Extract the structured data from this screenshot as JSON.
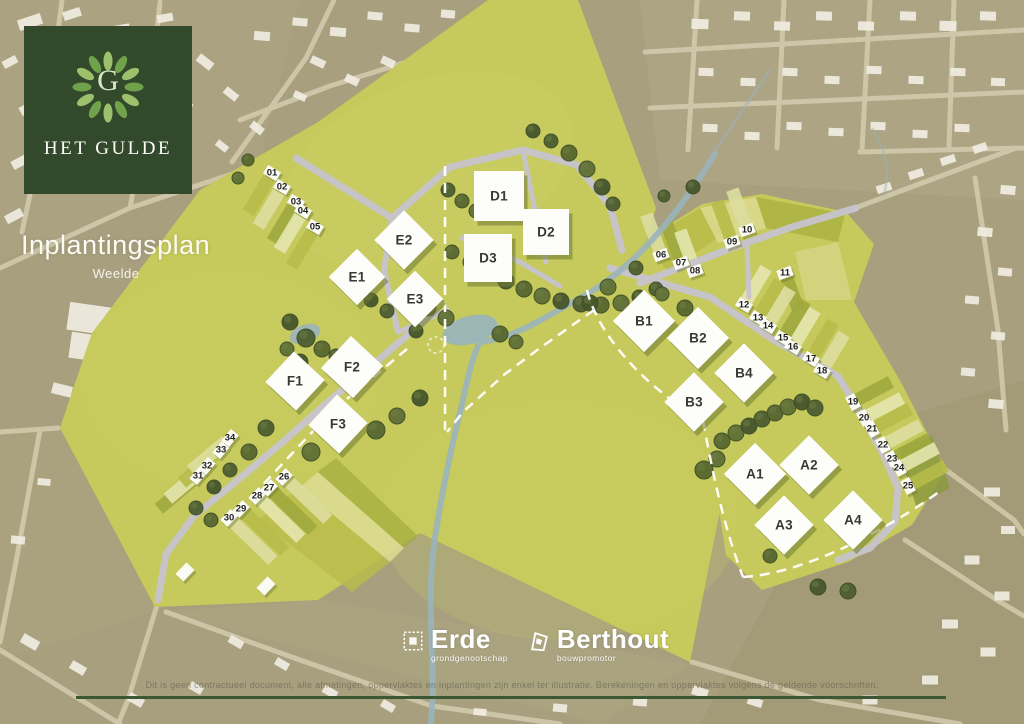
{
  "header": {
    "logo_monogram": "G",
    "brand_name": "HET GULDE",
    "title": "Inplantingsplan",
    "subtitle": "Weelde"
  },
  "partners": {
    "erde": {
      "name": "Erde",
      "tagline": "grondgenootschap"
    },
    "berthout": {
      "name": "Berthout",
      "tagline": "bouwpromotor"
    }
  },
  "footer": {
    "disclaimer": "Dit is geen contractueel document, alle afmetingen, oppervlaktes en inplantingen zijn enkel ter illustratie. Berekeningen en oppervlaktes volgens de geldende voorschriften."
  },
  "colors": {
    "site_green": "#c6c95b",
    "aerial_taupe": "#a79f7e",
    "road_grey": "#c7c4ce",
    "aerial_road": "#d9d2b5",
    "tree_green": "#4d5d31",
    "water_blue": "#9ab4bb",
    "logo_green": "#33492c",
    "footer_line_green": "#3b5733",
    "building_white": "#f0ede2",
    "parcel_palette": [
      "#b7bb49",
      "#dddea0",
      "#9fa93e",
      "#e4e5ae"
    ]
  },
  "map": {
    "groups": [
      {
        "angle": 31,
        "prot": 121,
        "poff": 26,
        "plen": 40
      },
      {
        "angle": -20,
        "prot": -110,
        "poff": 24,
        "plen": 38
      },
      {
        "angle": -20,
        "prot": -110,
        "poff": 24,
        "plen": 38
      },
      {
        "angle": -20,
        "prot": 70,
        "poff": 22,
        "plen": 34
      },
      {
        "angle": 31,
        "prot": -59,
        "poff": 24,
        "plen": 38
      },
      {
        "angle": 62,
        "prot": -28,
        "poff": 24,
        "plen": 38
      },
      {
        "angle": -46,
        "prot": 44,
        "poff": 32,
        "plen": 58
      },
      {
        "angle": -50,
        "prot": 140,
        "poff": 28,
        "plen": 46
      }
    ],
    "lots": [
      {
        "n": "01",
        "x": 272,
        "y": 173,
        "g": 0
      },
      {
        "n": "02",
        "x": 282,
        "y": 187,
        "g": 0
      },
      {
        "n": "03",
        "x": 296,
        "y": 202,
        "g": 0
      },
      {
        "n": "04",
        "x": 303,
        "y": 211,
        "g": 0
      },
      {
        "n": "05",
        "x": 315,
        "y": 227,
        "g": 0
      },
      {
        "n": "06",
        "x": 661,
        "y": 255,
        "g": 1
      },
      {
        "n": "07",
        "x": 681,
        "y": 263,
        "g": 1
      },
      {
        "n": "08",
        "x": 695,
        "y": 271,
        "g": 1
      },
      {
        "n": "09",
        "x": 732,
        "y": 242,
        "g": 2
      },
      {
        "n": "10",
        "x": 747,
        "y": 230,
        "g": 2
      },
      {
        "n": "11",
        "x": 785,
        "y": 273,
        "g": 3
      },
      {
        "n": "12",
        "x": 744,
        "y": 305,
        "g": 4
      },
      {
        "n": "13",
        "x": 758,
        "y": 318,
        "g": 4
      },
      {
        "n": "14",
        "x": 768,
        "y": 326,
        "g": 4
      },
      {
        "n": "15",
        "x": 783,
        "y": 338,
        "g": 4
      },
      {
        "n": "16",
        "x": 793,
        "y": 347,
        "g": 4
      },
      {
        "n": "17",
        "x": 811,
        "y": 359,
        "g": 4
      },
      {
        "n": "18",
        "x": 822,
        "y": 371,
        "g": 4
      },
      {
        "n": "19",
        "x": 853,
        "y": 402,
        "g": 5
      },
      {
        "n": "20",
        "x": 864,
        "y": 418,
        "g": 5
      },
      {
        "n": "21",
        "x": 872,
        "y": 429,
        "g": 5
      },
      {
        "n": "22",
        "x": 883,
        "y": 445,
        "g": 5
      },
      {
        "n": "23",
        "x": 892,
        "y": 459,
        "g": 5
      },
      {
        "n": "24",
        "x": 899,
        "y": 468,
        "g": 5
      },
      {
        "n": "25",
        "x": 908,
        "y": 486,
        "g": 5
      },
      {
        "n": "26",
        "x": 284,
        "y": 477,
        "g": 6
      },
      {
        "n": "27",
        "x": 269,
        "y": 488,
        "g": 6
      },
      {
        "n": "28",
        "x": 257,
        "y": 496,
        "g": 6
      },
      {
        "n": "29",
        "x": 241,
        "y": 509,
        "g": 6
      },
      {
        "n": "30",
        "x": 229,
        "y": 518,
        "g": 6
      },
      {
        "n": "31",
        "x": 198,
        "y": 476,
        "g": 7
      },
      {
        "n": "32",
        "x": 207,
        "y": 466,
        "g": 7
      },
      {
        "n": "33",
        "x": 221,
        "y": 450,
        "g": 7
      },
      {
        "n": "34",
        "x": 230,
        "y": 438,
        "g": 7
      }
    ],
    "blocks": [
      {
        "id": "E1",
        "x": 357,
        "y": 277,
        "rot": 45,
        "s": 40
      },
      {
        "id": "E2",
        "x": 404,
        "y": 240,
        "rot": 45,
        "s": 42
      },
      {
        "id": "E3",
        "x": 415,
        "y": 299,
        "rot": 45,
        "s": 40
      },
      {
        "id": "D1",
        "x": 499,
        "y": 196,
        "rot": 0,
        "s": 50
      },
      {
        "id": "D2",
        "x": 546,
        "y": 232,
        "rot": 0,
        "s": 46
      },
      {
        "id": "D3",
        "x": 488,
        "y": 258,
        "rot": 0,
        "s": 48
      },
      {
        "id": "F1",
        "x": 295,
        "y": 381,
        "rot": 43,
        "s": 42
      },
      {
        "id": "F2",
        "x": 352,
        "y": 367,
        "rot": 43,
        "s": 44
      },
      {
        "id": "F3",
        "x": 338,
        "y": 424,
        "rot": 43,
        "s": 42
      },
      {
        "id": "B1",
        "x": 644,
        "y": 321,
        "rot": 45,
        "s": 44
      },
      {
        "id": "B2",
        "x": 698,
        "y": 338,
        "rot": 45,
        "s": 44
      },
      {
        "id": "B3",
        "x": 694,
        "y": 402,
        "rot": 45,
        "s": 42
      },
      {
        "id": "B4",
        "x": 744,
        "y": 373,
        "rot": 45,
        "s": 42
      },
      {
        "id": "A1",
        "x": 755,
        "y": 474,
        "rot": 45,
        "s": 44
      },
      {
        "id": "A2",
        "x": 809,
        "y": 465,
        "rot": 45,
        "s": 42
      },
      {
        "id": "A3",
        "x": 784,
        "y": 525,
        "rot": 45,
        "s": 42
      },
      {
        "id": "A4",
        "x": 853,
        "y": 520,
        "rot": 45,
        "s": 42
      }
    ]
  }
}
